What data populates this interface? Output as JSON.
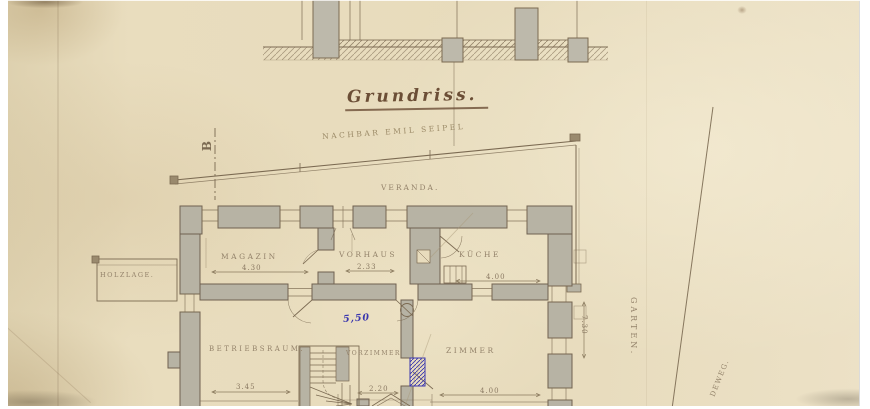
{
  "labels": {
    "title": "Grundriss.",
    "neighbor": "NACHBAR EMIL SEIPEL",
    "veranda": "VERANDA.",
    "section_marker": "B",
    "holzlage": "HOLZLAGE.",
    "garten": "GARTEN.",
    "weg": "DEWEG."
  },
  "rooms": [
    {
      "name": "MAGAZIN",
      "dim": "4.30"
    },
    {
      "name": "VORHAUS",
      "dim": "2.33"
    },
    {
      "name": "KÜCHE",
      "dim": "4.00"
    },
    {
      "name": "BETRIEBSRAUM.",
      "dim": "3.45"
    },
    {
      "name": "VORZIMMER",
      "dim": "2.20"
    },
    {
      "name": "ZIMMER",
      "dim": "4.00"
    }
  ],
  "annotations": {
    "blue_pencil": "5,50",
    "garden_side_dim": "7.30"
  },
  "colors": {
    "paper": "#e8dcbd",
    "ink": "#7b6a52",
    "wall_fill": "#b7b3a4",
    "blue_ink": "#3a36ae"
  }
}
